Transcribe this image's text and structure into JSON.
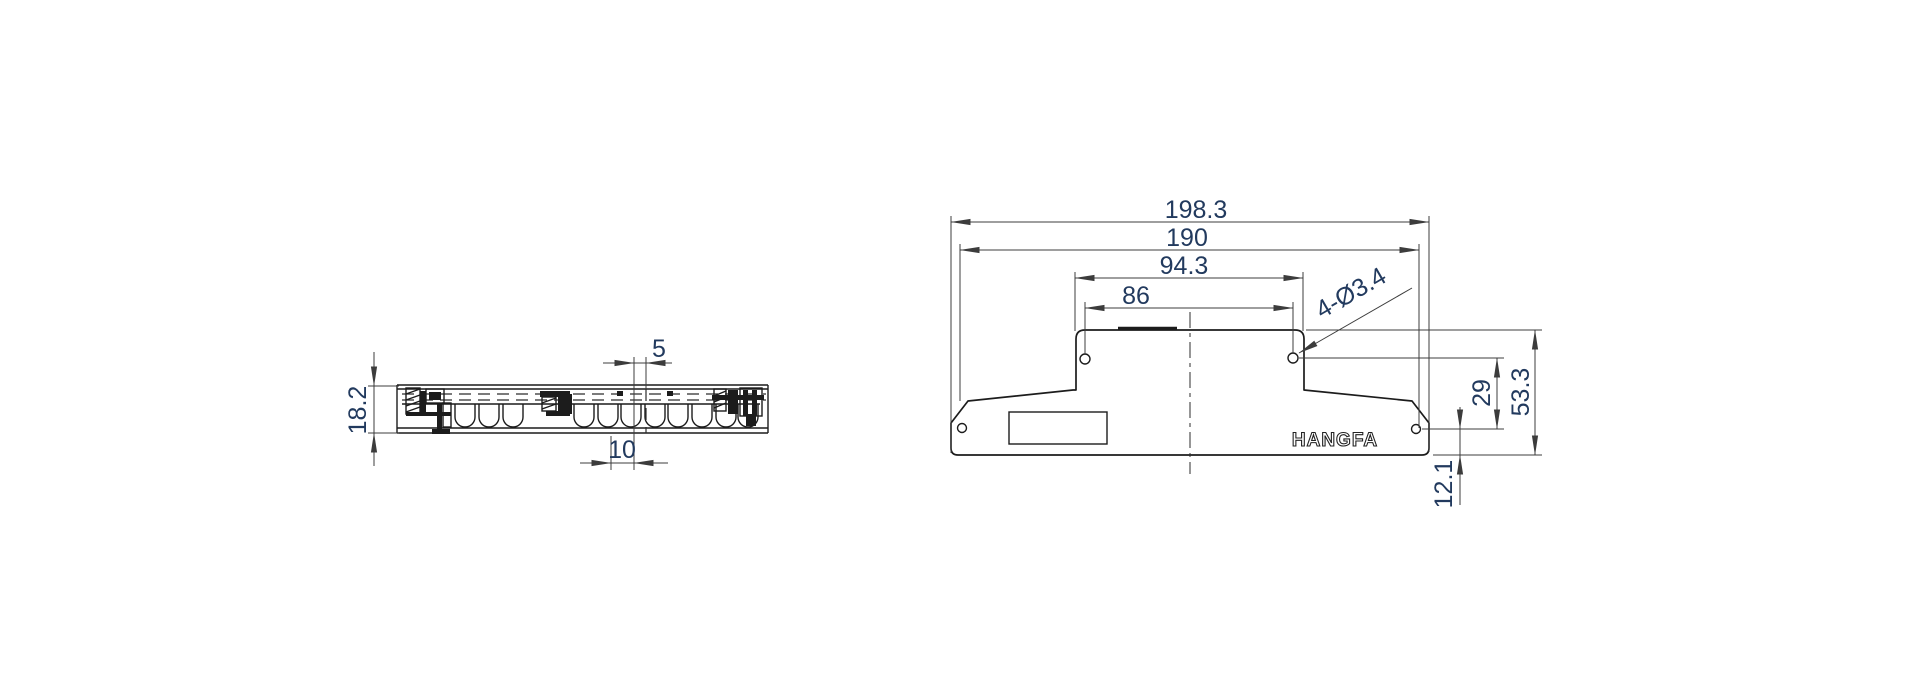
{
  "drawing": {
    "brand_label": "HANGFA",
    "front_view": {
      "dim_overall_width": "198.3",
      "dim_shoulder_width": "190",
      "dim_top_width": "94.3",
      "dim_top_hole_span": "86",
      "holes_callout": "4-Ø3.4",
      "dim_hole_rows_spacing": "29",
      "dim_overall_height": "53.3",
      "dim_lower_hole_offset": "12.1"
    },
    "side_view": {
      "dim_thickness": "18.2",
      "dim_slot_width": "5",
      "dim_slot_pitch": "10"
    }
  }
}
